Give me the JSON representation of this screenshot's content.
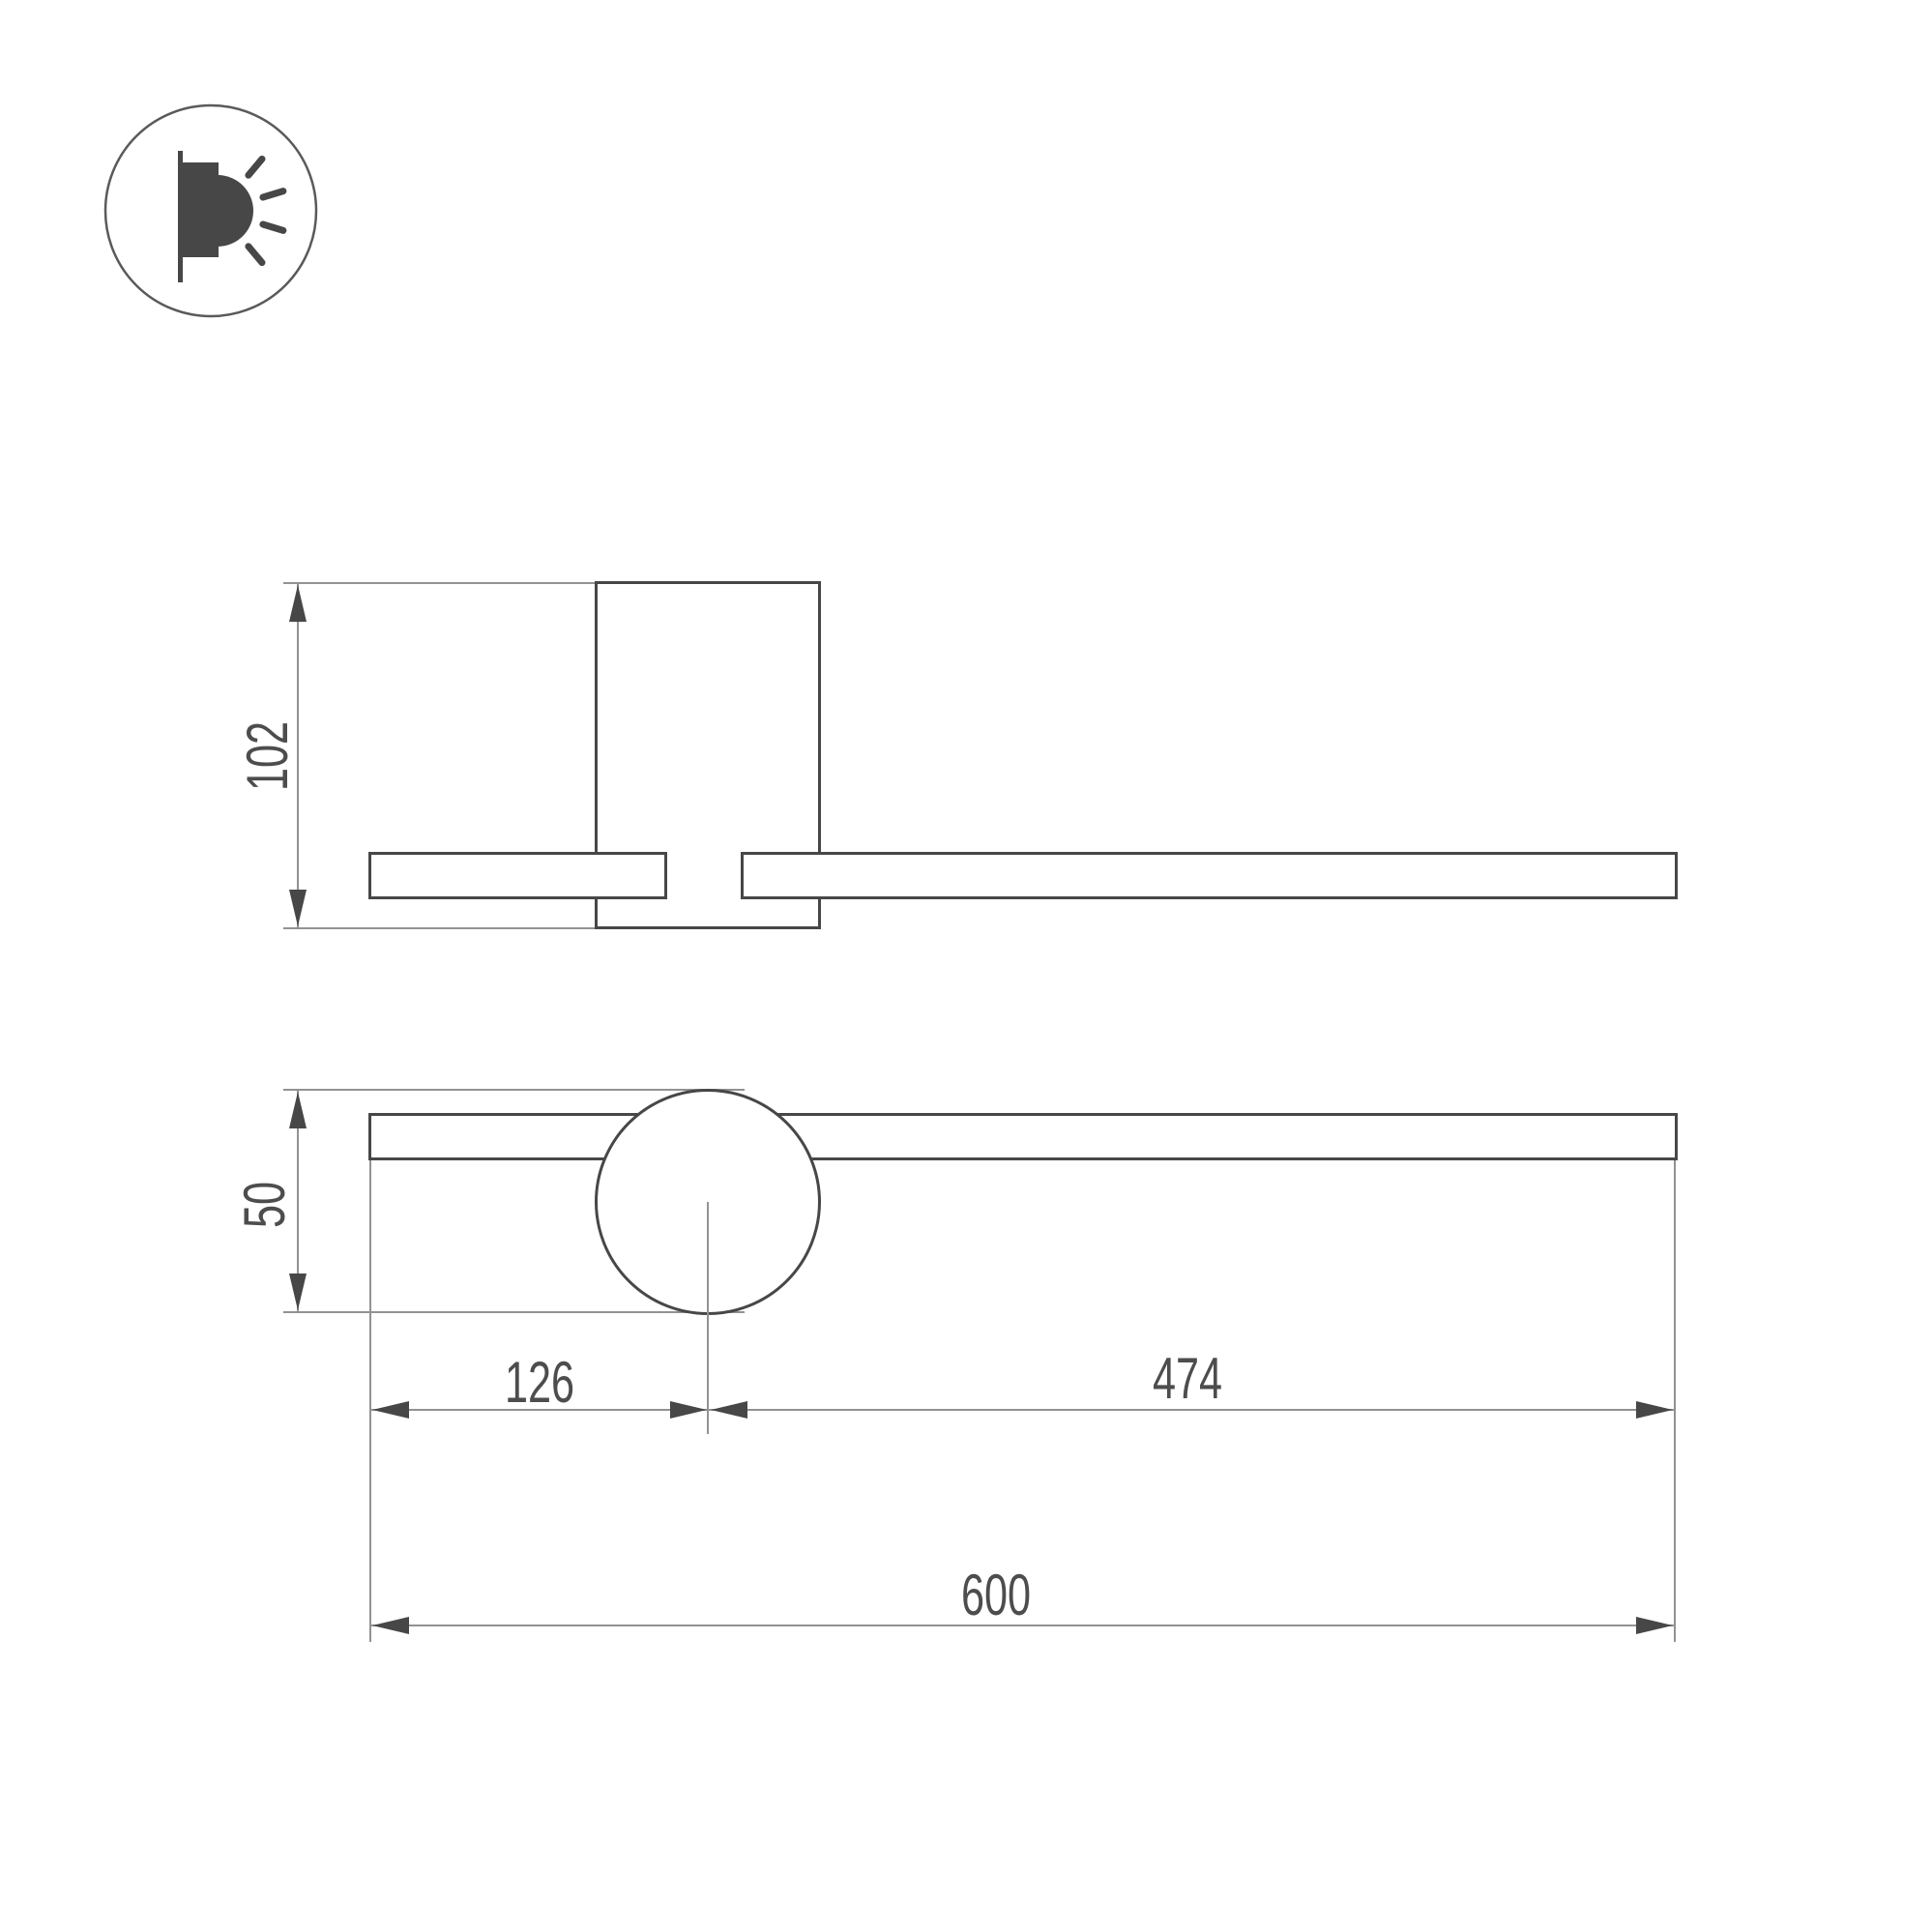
{
  "meta": {
    "type": "technical-dimension-drawing",
    "subject": "wall-mounted rotatable bar luminaire"
  },
  "icon": {
    "name": "wall-light-emission-icon"
  },
  "dimensions": {
    "side_height": "102",
    "front_height": "50",
    "offset_left": "126",
    "offset_right": "474",
    "total_length": "600"
  },
  "colors": {
    "object_line": "#474747",
    "dimension_line": "#929292",
    "text": "#4d4d4d",
    "background": "#ffffff"
  }
}
